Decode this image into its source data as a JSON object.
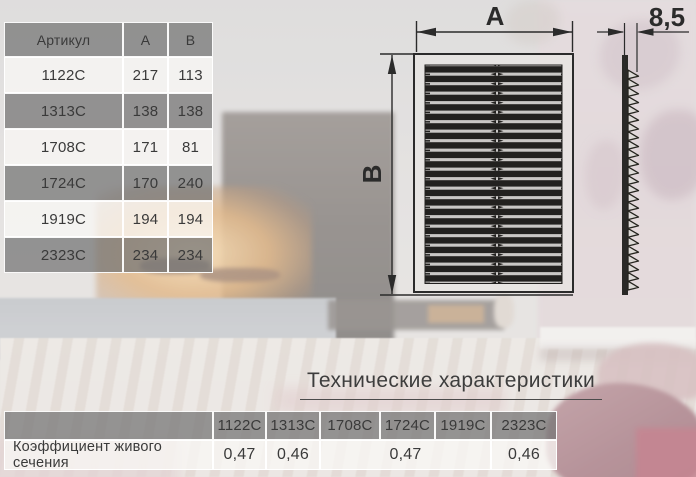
{
  "spec_table": {
    "headers": [
      "Артикул",
      "A",
      "B"
    ],
    "rows": [
      {
        "art": "1122C",
        "a": "217",
        "b": "113"
      },
      {
        "art": "1313C",
        "a": "138",
        "b": "138"
      },
      {
        "art": "1708C",
        "a": "171",
        "b": "81"
      },
      {
        "art": "1724C",
        "a": "170",
        "b": "240"
      },
      {
        "art": "1919C",
        "a": "194",
        "b": "194"
      },
      {
        "art": "2323C",
        "a": "234",
        "b": "234"
      }
    ]
  },
  "drawing": {
    "width_label": "A",
    "height_label": "B",
    "depth_label": "8,5"
  },
  "tech": {
    "title": "Технические характеристики",
    "columns": [
      "1122C",
      "1313C",
      "1708C",
      "1724C",
      "1919C",
      "2323C"
    ],
    "row_label": "Коэффициент живого сечения",
    "values": [
      {
        "text": "0,47"
      },
      {
        "text": "0,46"
      },
      {
        "text": "0,47"
      },
      {
        "text": "0,46"
      }
    ]
  },
  "colors": {
    "ink": "#3a3a3a",
    "drawing_ink": "#2b2b2b",
    "header_gray": "#9b9b9b",
    "row_light": "#f2f0ee",
    "accent_glow": "#d09048",
    "pillow": "#8a515c"
  }
}
